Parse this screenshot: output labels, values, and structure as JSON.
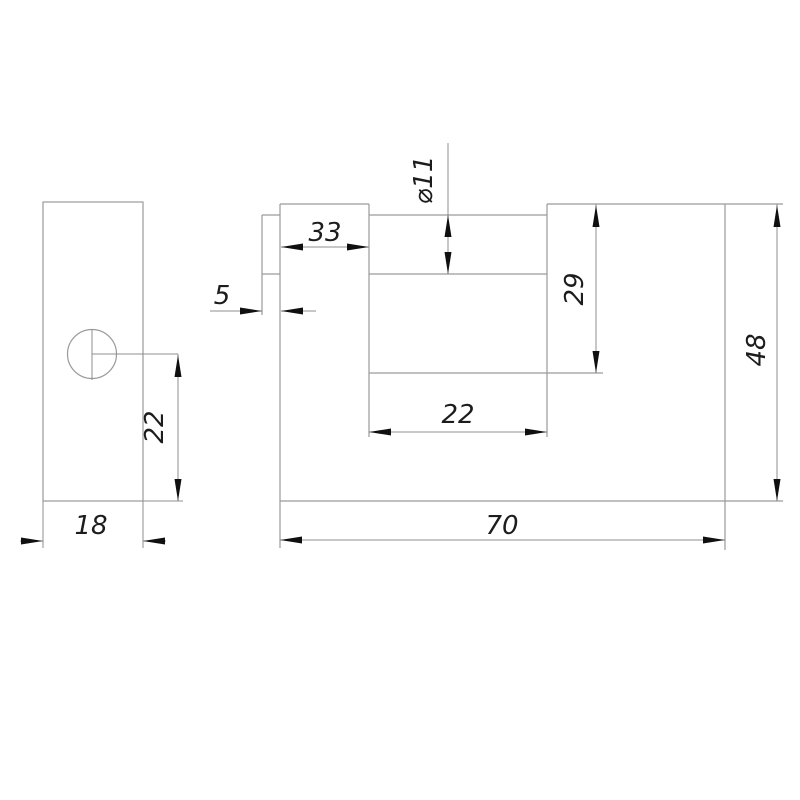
{
  "drawing": {
    "type": "technical-drawing",
    "subject": "rectangular shutter padlock body, two orthographic views",
    "background_color": "#ffffff",
    "geometry_line_color": "#9a9a9a",
    "dimension_line_color": "#8f8f8f",
    "arrow_color": "#101010",
    "text_color": "#1c1c1c"
  },
  "dims": {
    "side_width": "18",
    "side_hole_offset": "22",
    "shackle_protrusion": "5",
    "left_block_width": "33",
    "shackle_diameter": "⌀11",
    "slot_depth": "29",
    "slot_width": "22",
    "body_width": "70",
    "body_height": "48"
  }
}
